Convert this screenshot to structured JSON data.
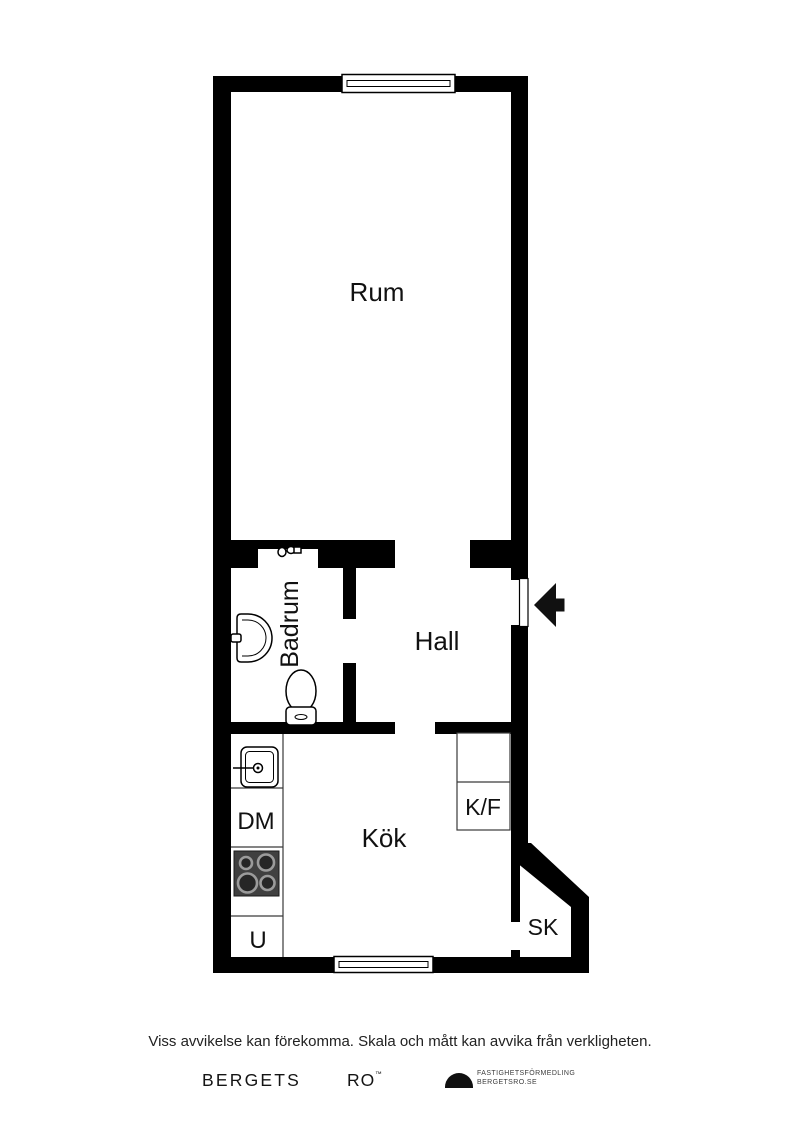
{
  "plan": {
    "room_labels": {
      "rum": "Rum",
      "badrum": "Badrum",
      "hall": "Hall",
      "kok": "Kök",
      "sk": "SK"
    },
    "appliance_labels": {
      "kf": "K/F",
      "dm": "DM",
      "u": "U"
    },
    "icons": {
      "toilet": "toilet-icon",
      "bathroom_sink": "bathroom-sink-icon",
      "faucet": "faucet-icon",
      "kitchen_sink": "kitchen-sink-icon",
      "stove": "stove-icon",
      "entrance_arrow": "entrance-arrow-icon",
      "window": "window-symbol",
      "logo_dome": "dome-logo-icon"
    }
  },
  "colors": {
    "wall": "#000000",
    "background": "#ffffff",
    "stove_surface": "#404040",
    "burner_ring": "#9b9b9b",
    "text": "#111111"
  },
  "footer": {
    "disclaimer": "Viss avvikelse kan förekomma. Skala och mått kan avvika från verkligheten.",
    "brand_word1": "BERGETS",
    "brand_word2": "RO",
    "trademark": "™",
    "agency_line1": "FASTIGHETSFÖRMEDLING",
    "agency_line2": "BERGETSRO.SE"
  }
}
